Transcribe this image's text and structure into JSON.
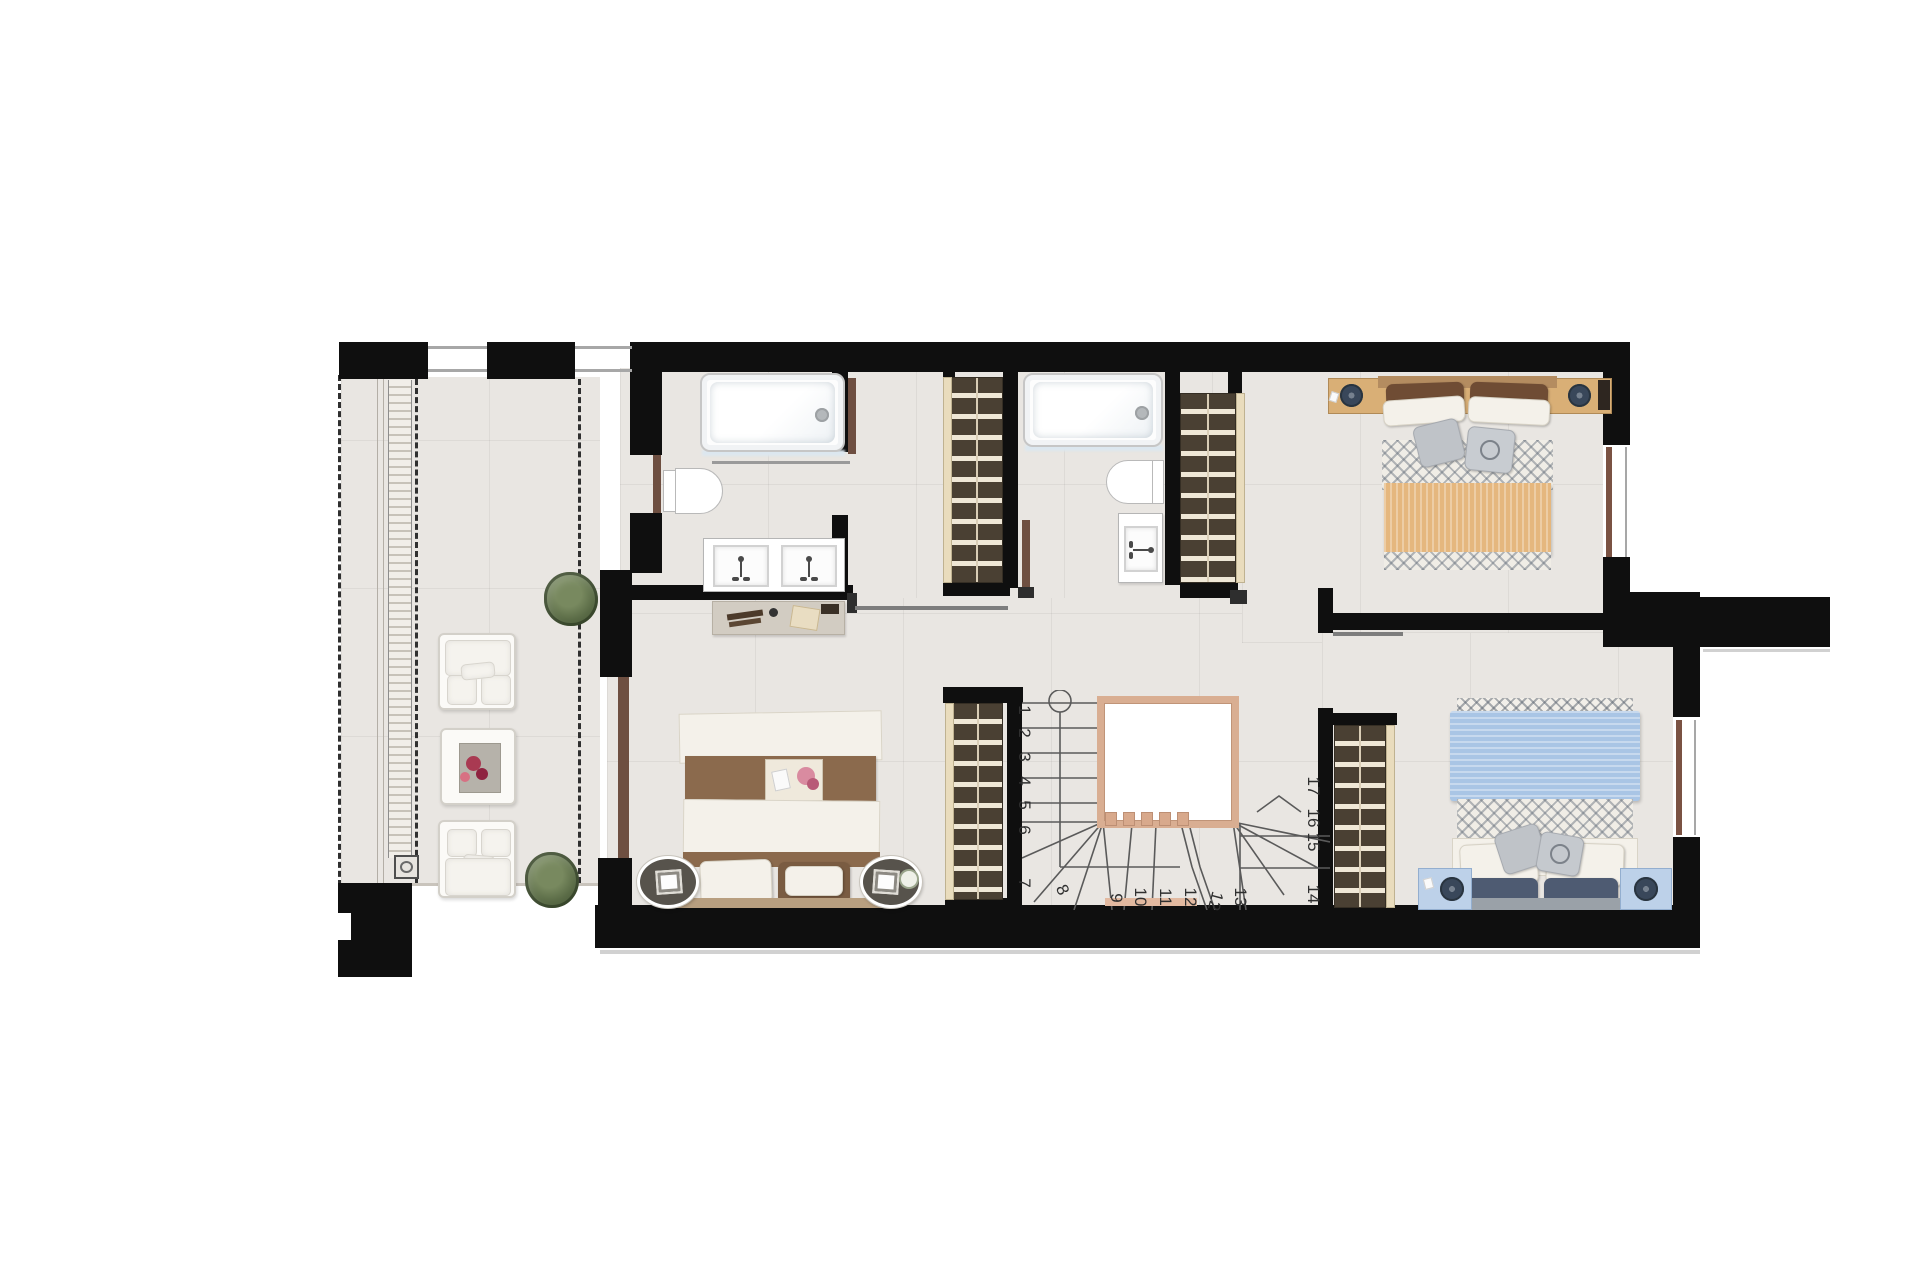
{
  "document": {
    "type": "residential-floor-plan",
    "floor": "upper-floor",
    "rooms_visible": 7
  },
  "stairs": {
    "left_run": [
      "1",
      "2",
      "3",
      "4",
      "5",
      "6",
      "7"
    ],
    "bottom_run": [
      "8",
      "9",
      "10",
      "11",
      "12",
      "12",
      "13"
    ],
    "right_run": [
      "17",
      "16",
      "15",
      "14"
    ]
  },
  "colors": {
    "wall": "#0f0f0f",
    "floor": "#e9e6e2",
    "wardrobe": "#4a4033",
    "wardrobe_slat": "#efe7d6",
    "stair_void_border": "#d9ae92",
    "door_leaf": "#6e4f41",
    "bed_tan_blanket": "#e5b77e",
    "bed_blue_blanket": "#a9c5e5",
    "bed_brown": "#8b6a4d",
    "plant_green": "#5a6b46"
  },
  "fixtures": {
    "bathtubs": 2,
    "toilets": 2,
    "sinks": 3,
    "wardrobes": 4,
    "double_beds": 3,
    "terrace_armchairs": 2,
    "plants": 2,
    "staircase_steps": 17
  }
}
